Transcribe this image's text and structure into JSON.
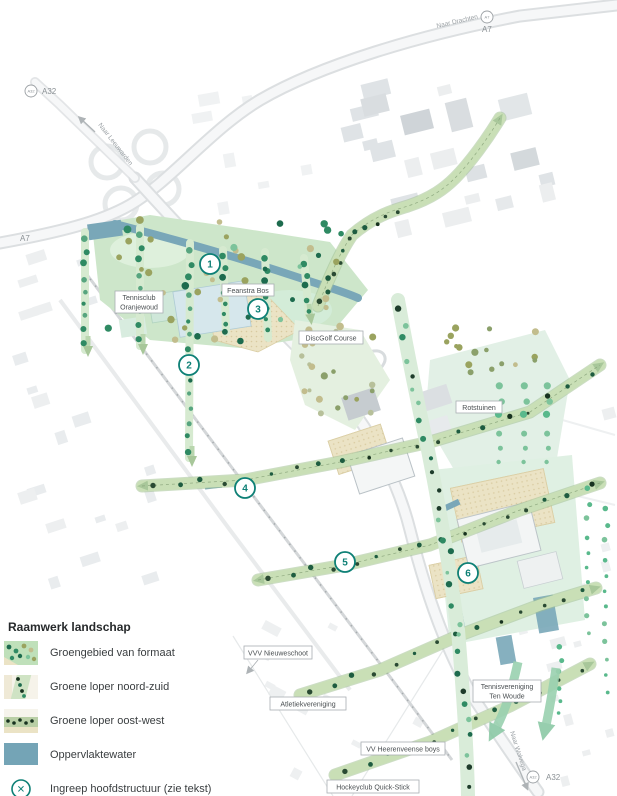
{
  "legend": {
    "title": "Raamwerk landschap",
    "items": [
      {
        "label": "Groengebied van formaat",
        "swatch": "green-area-thumbnail"
      },
      {
        "label": "Groene loper noord-zuid",
        "swatch": "green-corridor-ns-thumbnail"
      },
      {
        "label": "Groene loper oost-west",
        "swatch": "green-corridor-ew-thumbnail"
      },
      {
        "label": "Oppervlaktewater",
        "swatch": "water-swatch"
      },
      {
        "label": "Ingreep hoofdstructuur (zie tekst)",
        "swatch": "circled-x-icon"
      }
    ],
    "intervention_symbol": "✕"
  },
  "map": {
    "markers": [
      {
        "number": "1"
      },
      {
        "number": "2"
      },
      {
        "number": "3"
      },
      {
        "number": "4"
      },
      {
        "number": "5"
      },
      {
        "number": "6"
      }
    ],
    "labels": {
      "tennisclub": {
        "line1": "Tennisclub",
        "line2": "Oranjewoud"
      },
      "feanstra": "Feanstra Bos",
      "discgolf": "DiscGolf Course",
      "rotstuinen": "Rotstuinen",
      "vvv_nieuweschoot": "VVV Nieuweschoot",
      "atletiek": "Atletiekvereniging",
      "heerenveense_boys": "VV Heerenveense boys",
      "hockeyclub": "Hockeyclub Quick-Stick",
      "tennisvereniging": {
        "line1": "Tennisvereniging",
        "line2": "Ten Woude"
      }
    },
    "roads": {
      "a32_label": "A32",
      "a7_label": "A7",
      "naar_leeuwarden": "Naar Leeuwarden",
      "naar_drachten": "Naar Drachten",
      "naar_wolvega": "Naar Wolvega"
    },
    "colors": {
      "accent_teal": "#0e8076",
      "water_blue": "#74a4b6",
      "corridor_green": "#c9dfb6",
      "tree_dark_green": "#1d6b4e",
      "mint_green": "#def0e2",
      "sand_beige": "#ebe3c5"
    }
  }
}
